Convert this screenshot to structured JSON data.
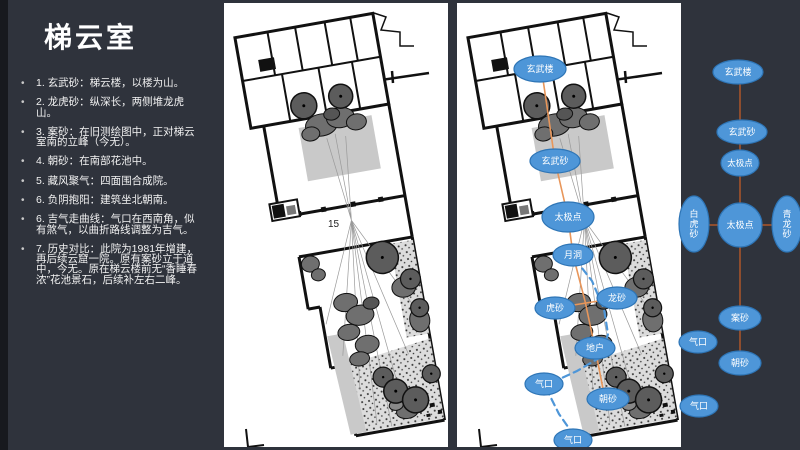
{
  "slide": {
    "title": "梯云室"
  },
  "bullets": [
    "1. 玄武砂：梯云楼，以楼为山。",
    "2. 龙虎砂：纵深长，两侧堆龙虎山。",
    "3. 案砂：在旧测绘图中，正对梯云室南的立峰（今无）。",
    "4. 朝砂：在南部花池中。",
    "5. 藏风聚气：四面围合成院。",
    "6. 负阴抱阳：建筑坐北朝南。",
    "6. 吉气走曲线：气口在西南角，似有煞气，以曲折路线调整为吉气。",
    "7. 历史对比：此院为1981年增建，再后续云窟一院。原有案砂立于道中，今无。原在梯云楼前无“香睡春浓”花池景石，后续补左右二峰。"
  ],
  "plan": {
    "label_15": "15"
  },
  "colors": {
    "background": "#2F333C",
    "panel": "#FFFFFF",
    "node_fill": "#4E96D8",
    "node_stroke": "#2E75B6",
    "node_text": "#FFFFFF",
    "plan_axis": "#E8965A",
    "qi_path": "#4E96D8",
    "sidebar_line": "#8E4D2E"
  },
  "plan_overlay": {
    "axis_points": "83,56 98,158 111,214 116,252 128,298 138,345 148,396",
    "cross_points": "98,305 160,295",
    "qi_path_points": "118,256 135,278 147,306 151,331 144,354 120,368 96,379 92,391 102,411 116,431 117,437",
    "nodes": [
      {
        "name": "xuanwu-lou",
        "label": "玄武楼",
        "x": 83,
        "y": 66,
        "rx": 26,
        "ry": 13,
        "fs": 9
      },
      {
        "name": "xuanwu-sha",
        "label": "玄武砂",
        "x": 98,
        "y": 158,
        "rx": 25,
        "ry": 12,
        "fs": 9
      },
      {
        "name": "taiji-dian",
        "label": "太极点",
        "x": 111,
        "y": 214,
        "rx": 26,
        "ry": 15,
        "fs": 9
      },
      {
        "name": "yue-dong",
        "label": "月洞",
        "x": 116,
        "y": 252,
        "rx": 20,
        "ry": 11,
        "fs": 9
      },
      {
        "name": "long-sha",
        "label": "龙砂",
        "x": 160,
        "y": 295,
        "rx": 20,
        "ry": 11,
        "fs": 9
      },
      {
        "name": "hu-sha",
        "label": "虎砂",
        "x": 98,
        "y": 305,
        "rx": 20,
        "ry": 11,
        "fs": 9
      },
      {
        "name": "di-hu",
        "label": "地户",
        "x": 138,
        "y": 345,
        "rx": 20,
        "ry": 11,
        "fs": 9
      },
      {
        "name": "qi-kou-left",
        "label": "气口",
        "x": 87,
        "y": 381,
        "rx": 19,
        "ry": 11,
        "fs": 9
      },
      {
        "name": "chao-sha",
        "label": "朝砂",
        "x": 151,
        "y": 396,
        "rx": 21,
        "ry": 11,
        "fs": 9
      },
      {
        "name": "qi-kou-bottom",
        "label": "气口",
        "x": 116,
        "y": 437,
        "rx": 19,
        "ry": 11,
        "fs": 9
      }
    ]
  },
  "sidebar_diagram": {
    "vline": {
      "x": 80,
      "y1": 72,
      "y2": 363
    },
    "hline": {
      "x1": 34,
      "x2": 127,
      "y": 225
    },
    "nodes": [
      {
        "name": "xuanwu-lou",
        "label": "玄武楼",
        "x": 78,
        "y": 72,
        "rx": 25,
        "ry": 12,
        "fs": 9
      },
      {
        "name": "xuanwu-sha",
        "label": "玄武砂",
        "x": 82,
        "y": 132,
        "rx": 25,
        "ry": 12,
        "fs": 9
      },
      {
        "name": "taiji-dian-upper",
        "label": "太极点",
        "x": 80,
        "y": 163,
        "rx": 19,
        "ry": 13,
        "fs": 8.5
      },
      {
        "name": "baihu-sha",
        "label": "白虎砂",
        "x": 34,
        "y": 224,
        "rx": 15,
        "ry": 28,
        "fs": 9,
        "vertical": true
      },
      {
        "name": "taiji-dian-center",
        "label": "太极点",
        "x": 80,
        "y": 225,
        "rx": 22,
        "ry": 22,
        "fs": 9
      },
      {
        "name": "qinglong-sha",
        "label": "青龙砂",
        "x": 127,
        "y": 224,
        "rx": 15,
        "ry": 28,
        "fs": 9,
        "vertical": true
      },
      {
        "name": "an-sha",
        "label": "案砂",
        "x": 80,
        "y": 318,
        "rx": 21,
        "ry": 12,
        "fs": 9
      },
      {
        "name": "qi-kou-upper",
        "label": "气口",
        "x": 38,
        "y": 342,
        "rx": 19,
        "ry": 11,
        "fs": 9
      },
      {
        "name": "chao-sha",
        "label": "朝砂",
        "x": 80,
        "y": 363,
        "rx": 21,
        "ry": 12,
        "fs": 9
      },
      {
        "name": "qi-kou-lower",
        "label": "气口",
        "x": 39,
        "y": 406,
        "rx": 19,
        "ry": 11,
        "fs": 9
      }
    ]
  }
}
